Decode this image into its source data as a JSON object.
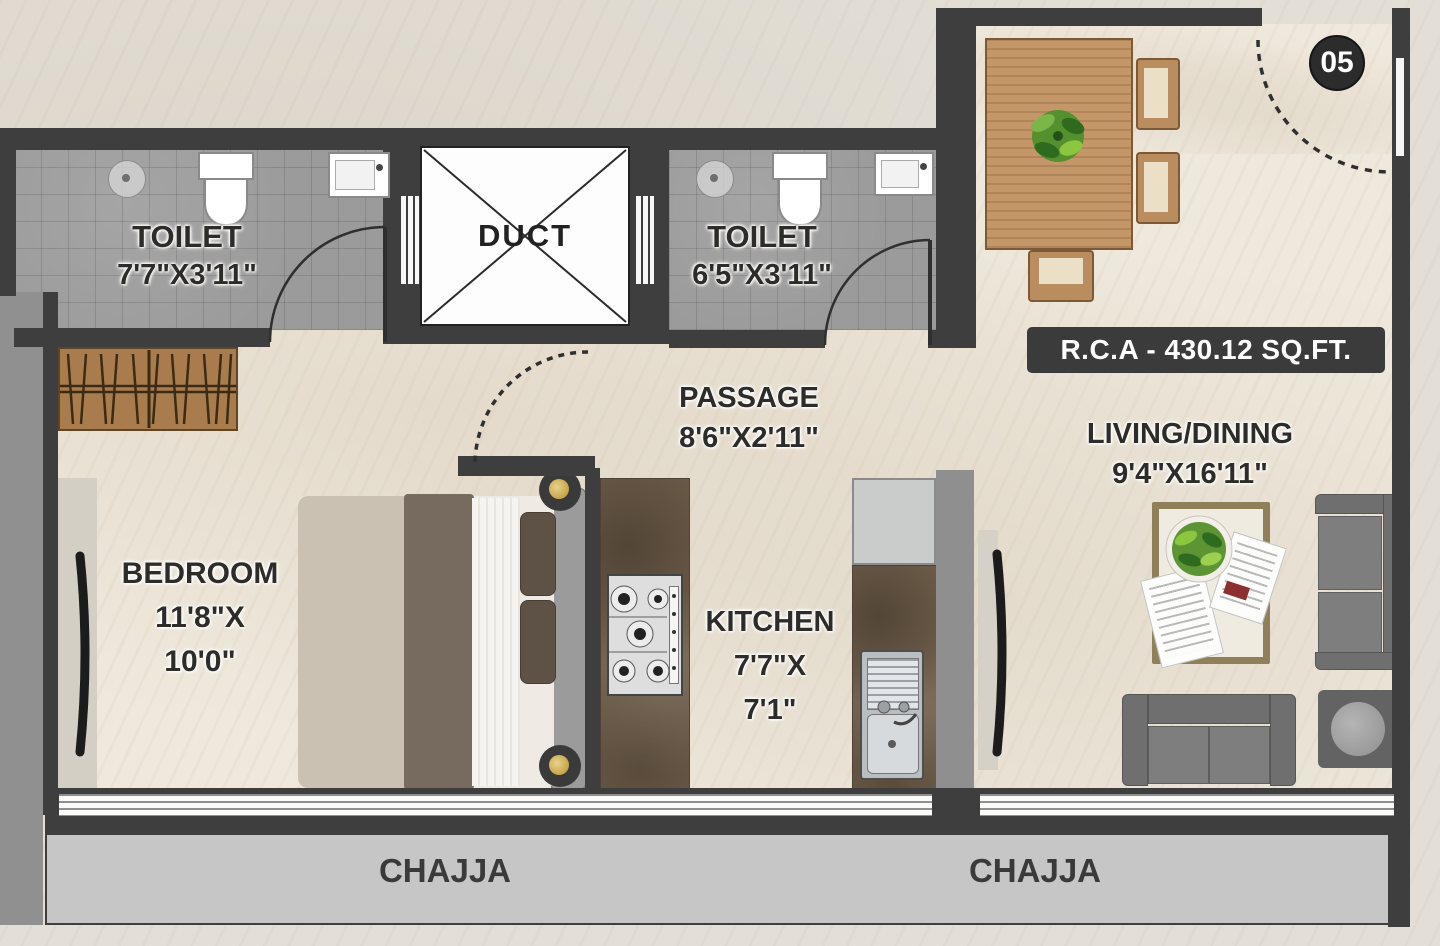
{
  "unit_badge": "05",
  "area_banner": "R.C.A - 430.12 SQ.FT.",
  "rooms": {
    "toilet1": {
      "name": "TOILET",
      "dims": "7'7\"X3'11\""
    },
    "duct": {
      "name": "DUCT"
    },
    "toilet2": {
      "name": "TOILET",
      "dims": "6'5\"X3'11\""
    },
    "passage": {
      "name": "PASSAGE",
      "dims": "8'6\"X2'11\""
    },
    "bedroom": {
      "name": "BEDROOM",
      "dims_line1": "11'8\"X",
      "dims_line2": "10'0\""
    },
    "kitchen": {
      "name": "KITCHEN",
      "dims_line1": "7'7\"X",
      "dims_line2": "7'1\""
    },
    "living_dining": {
      "name": "LIVING/DINING",
      "dims": "9'4\"X16'11\""
    },
    "chajja_left": "CHAJJA",
    "chajja_right": "CHAJJA"
  },
  "colors": {
    "wall": "#3e3e3e",
    "floor": "#efe9dd",
    "tile_floor": "#9b9b9b",
    "wood": "#c49768",
    "counter": "#72604c",
    "chajja": "#c6c6c6",
    "sofa": "#7e7e7e",
    "banner_bg": "#3b3b3b",
    "banner_text": "#ffffff",
    "label_text": "#2e2c29"
  }
}
